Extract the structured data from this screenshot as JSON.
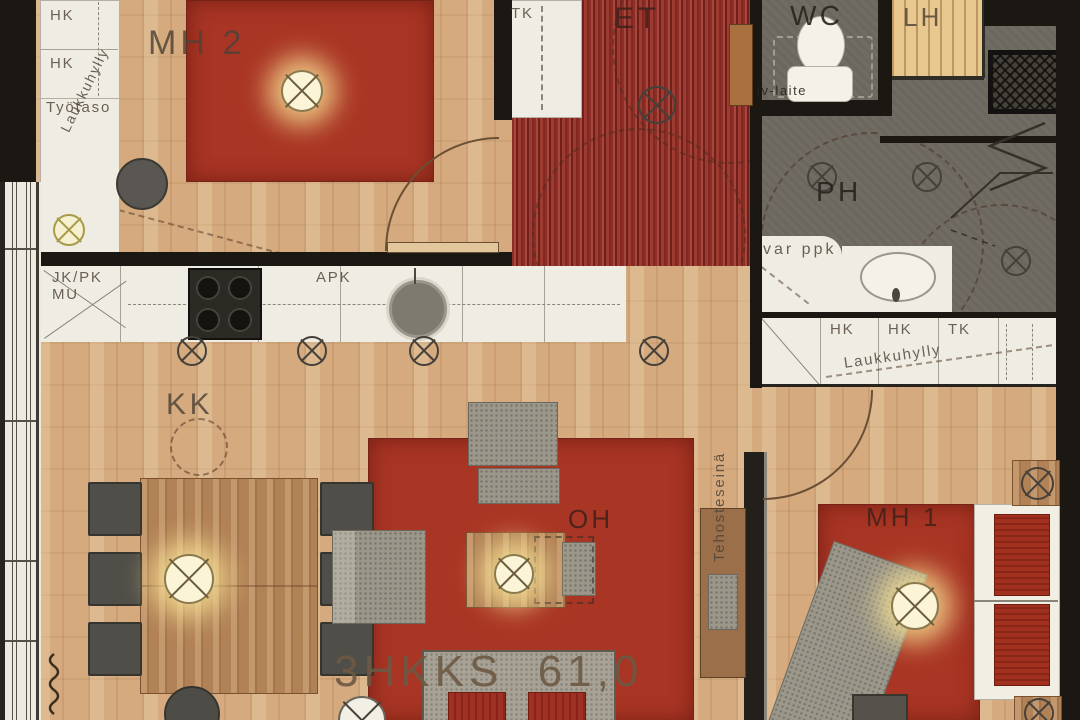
{
  "plan": {
    "area_label": "3HKKS  61,0",
    "rooms": {
      "mh2": "MH 2",
      "et": "ET",
      "wc": "WC",
      "lh": "LH",
      "ph": "PH",
      "kk": "KK",
      "oh": "OH",
      "mh1": "MH 1"
    },
    "hall_closet": "TK",
    "left_closets": {
      "hk1": "HK",
      "hk2": "HK",
      "shelf": "Laukkuhylly",
      "worktop": "Työtaso"
    },
    "kitchen": {
      "fridge": "JK/PK",
      "fridge2": "MU",
      "dishwasher": "APK"
    },
    "bathroom": {
      "washer_reservation": "var ppk"
    },
    "wc_room": {
      "vent_unit": "iv-laite"
    },
    "right_closets": {
      "hk1": "HK",
      "hk2": "HK",
      "tk": "TK",
      "shelf": "Laukkuhylly"
    },
    "accent_wall": "Tehosteseinä",
    "colors": {
      "wood_floor": "#d4aa7e",
      "red_rug": "#a93524",
      "wall": "#1b1814",
      "wet_room_floor": "#716c63",
      "cabinet_white": "#efede3",
      "sauna_bench": "#e8c88e",
      "stripe_rug_dark": "#701f1b",
      "stripe_rug_light": "#a5473c",
      "lamp_glow": "#f7e9b5"
    },
    "symbols": {
      "ceiling_light": "circle-cross",
      "pendant_light": "circle-cross-glow"
    }
  }
}
